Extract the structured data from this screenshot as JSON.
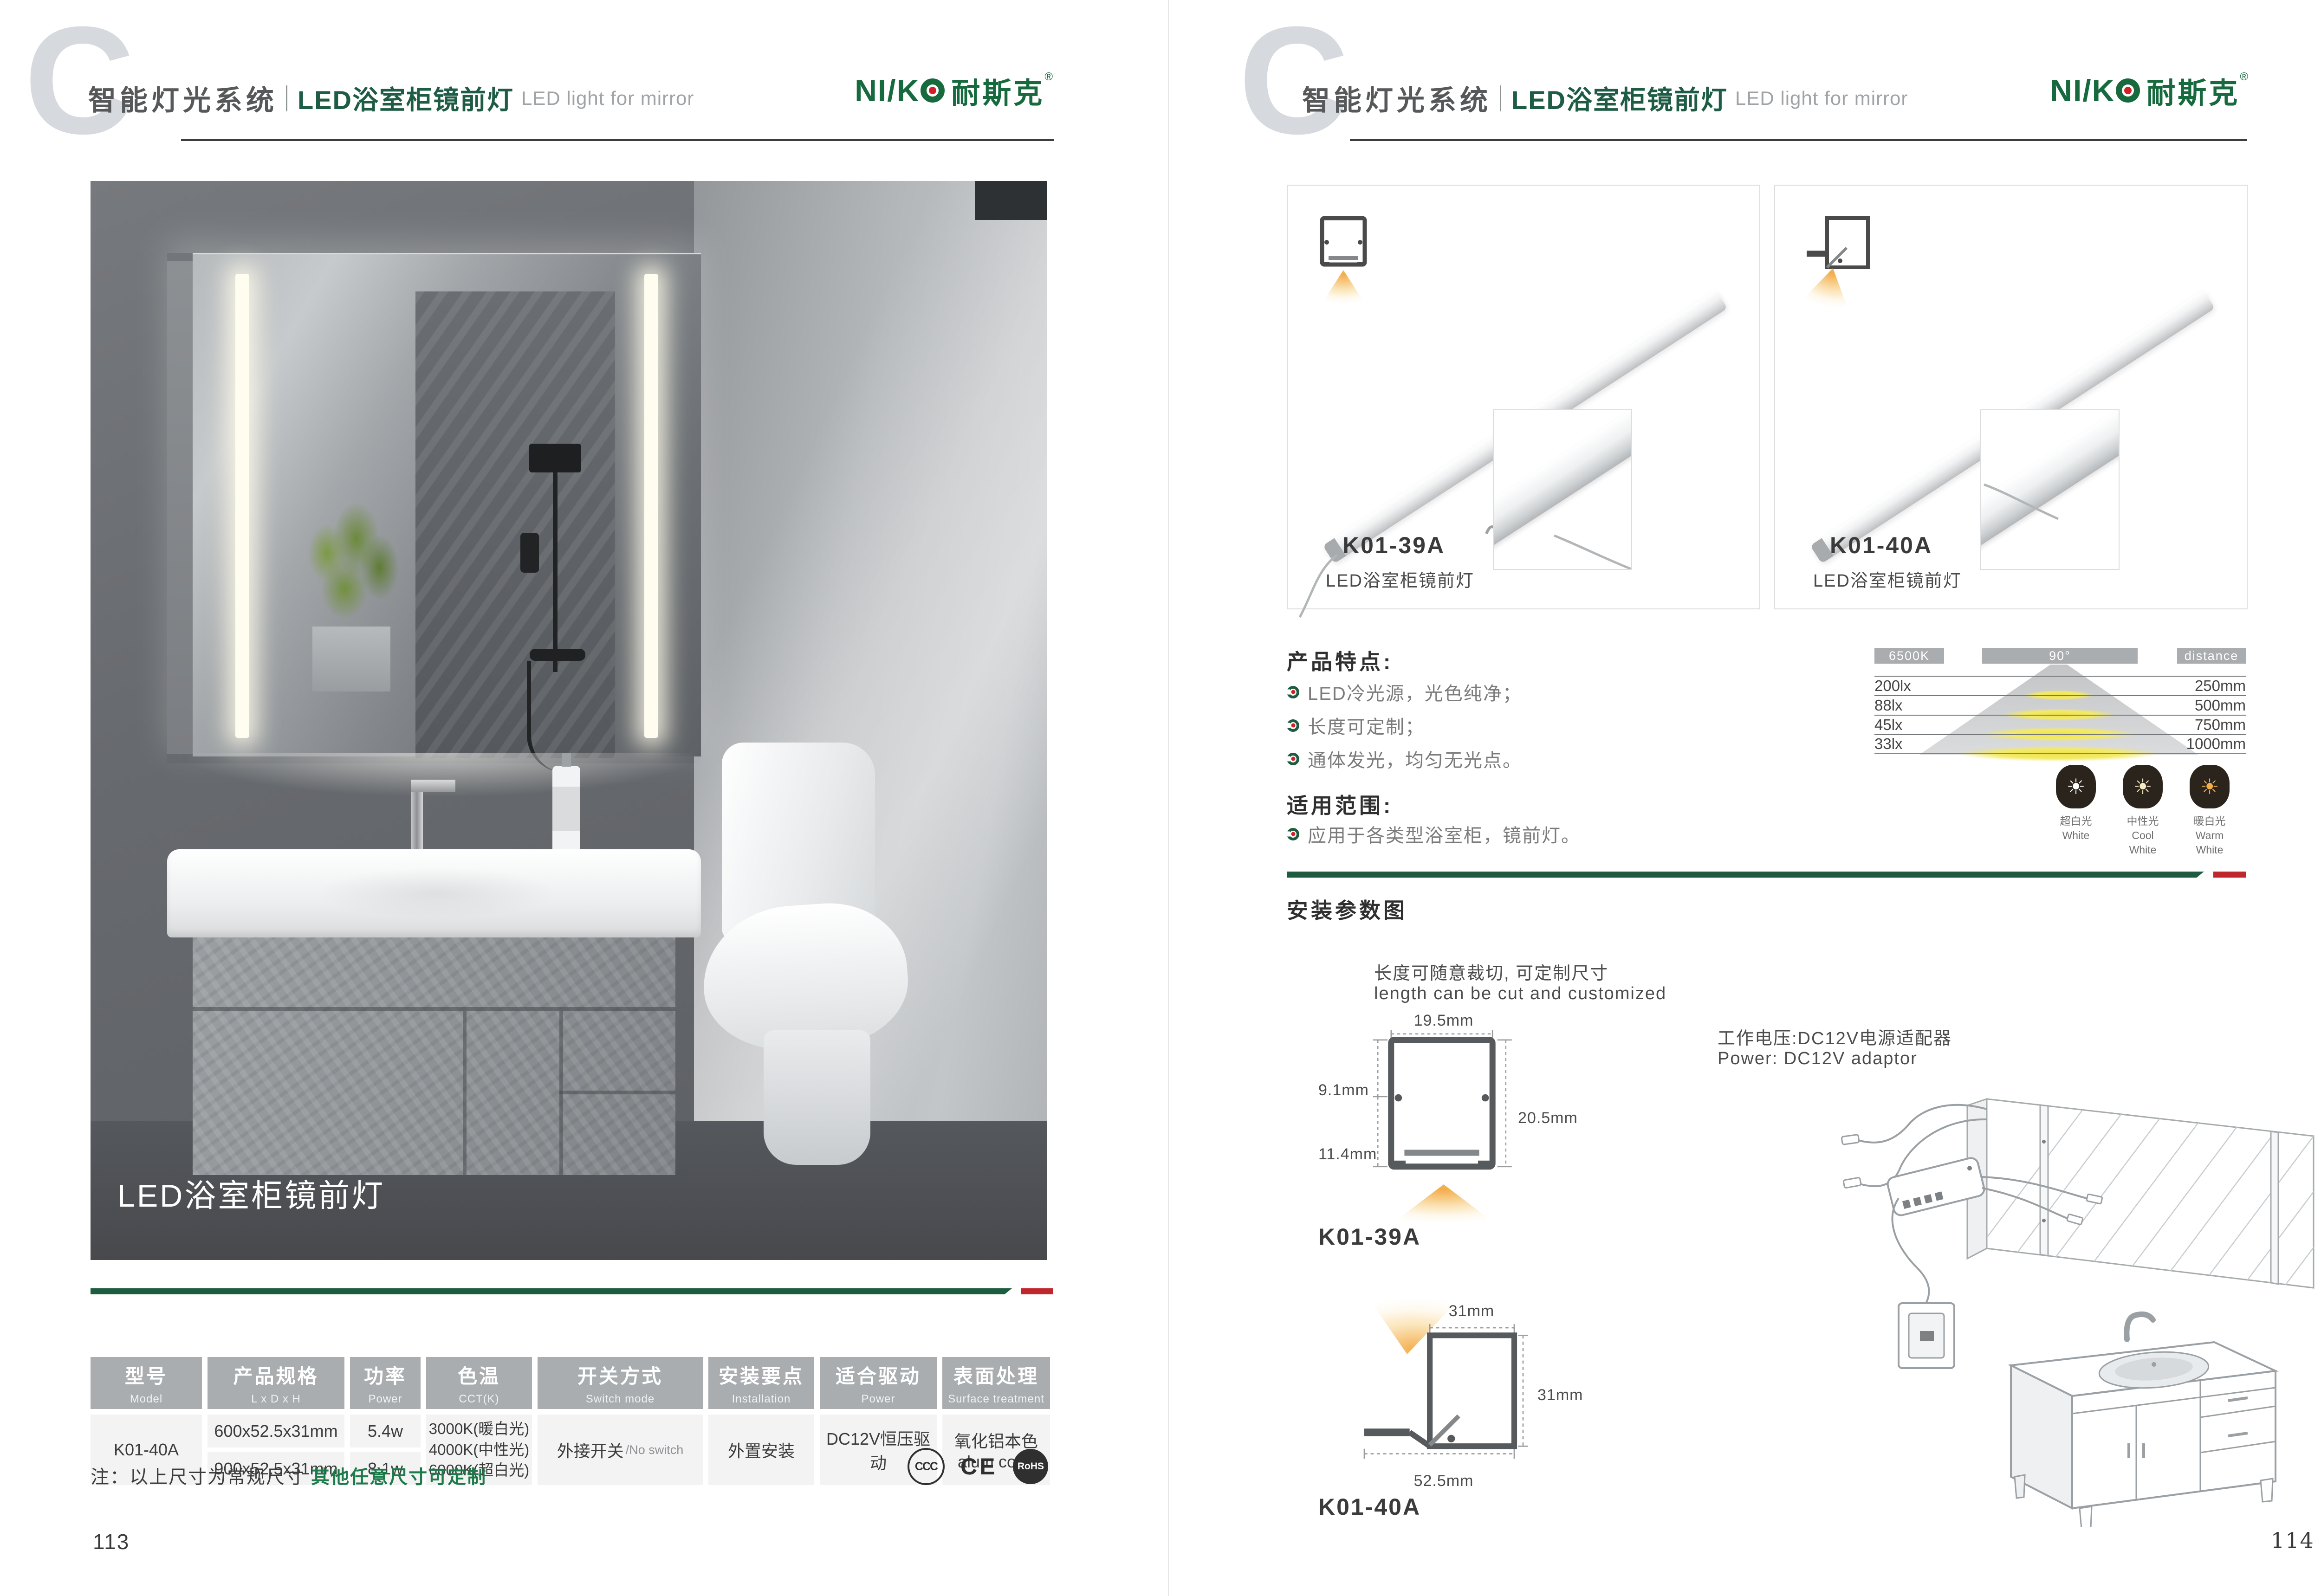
{
  "colors": {
    "brand_green": "#166a3d",
    "divider_green": "#1d5c40",
    "accent_red": "#c0272d",
    "table_header_gray": "#a9adb0"
  },
  "brand": {
    "latin": "NI/K",
    "cn": "耐斯克",
    "reg": "®"
  },
  "header": {
    "watermark": "C",
    "category": "智能灯光系统",
    "product_cn": "LED浴室柜镜前灯",
    "product_en": "LED light for mirror"
  },
  "left": {
    "photo_caption": "LED浴室柜镜前灯",
    "table_headers": [
      {
        "cn": "型号",
        "en": "Model"
      },
      {
        "cn": "产品规格",
        "en": "L x D x H"
      },
      {
        "cn": "功率",
        "en": "Power"
      },
      {
        "cn": "色温",
        "en": "CCT(K)"
      },
      {
        "cn": "开关方式",
        "en": "Switch mode"
      },
      {
        "cn": "安装要点",
        "en": "Installation"
      },
      {
        "cn": "适合驱动",
        "en": "Power"
      },
      {
        "cn": "表面处理",
        "en": "Surface treatment"
      }
    ],
    "row": {
      "model": "K01-40A",
      "spec1": "600x52.5x31mm",
      "spec2": "900x52.5x31mm",
      "power1": "5.4w",
      "power2": "8.1w",
      "cct1": "3000K(暖白光)",
      "cct2": "4000K(中性光)",
      "cct3": "6000K(超白光)",
      "switch_cn": "外接开关",
      "switch_en": "/No switch",
      "install": "外置安装",
      "driver": "DC12V恒压驱动",
      "surface_cn": "氧化铝本色",
      "surface_en": "alum color"
    },
    "note_prefix": "注：以上尺寸为常规尺寸 ",
    "note_highlight": "其他任意尺寸可定制",
    "certs": {
      "ccc": "CCC",
      "ce": "CE",
      "rohs": "RoHS"
    },
    "page_number": "113"
  },
  "right": {
    "products": [
      {
        "model": "K01-39A",
        "name": "LED浴室柜镜前灯"
      },
      {
        "model": "K01-40A",
        "name": "LED浴室柜镜前灯"
      }
    ],
    "features": {
      "title": "产品特点:",
      "items": [
        "LED冷光源，光色纯净；",
        "长度可定制；",
        "通体发光，均匀无光点。"
      ]
    },
    "application": {
      "title": "适用范围:",
      "item": "应用于各类型浴室柜，镜前灯。"
    },
    "photometry": {
      "col_cct": "6500K",
      "col_angle": "90°",
      "col_dist": "distance",
      "rows": [
        {
          "lux": "200lx",
          "dist": "250mm"
        },
        {
          "lux": "88lx",
          "dist": "500mm"
        },
        {
          "lux": "45lx",
          "dist": "750mm"
        },
        {
          "lux": "33lx",
          "dist": "1000mm"
        }
      ]
    },
    "cct_icons": [
      {
        "cn": "超白光",
        "en": "White",
        "color": "#ffffff"
      },
      {
        "cn": "中性光",
        "en": "Cool White",
        "color": "#f6ecc4"
      },
      {
        "cn": "暖白光",
        "en": "Warm White",
        "color": "#f2ae49"
      }
    ],
    "install": {
      "title": "安装参数图",
      "cut_cn": "长度可随意裁切, 可定制尺寸",
      "cut_en": "length can be cut and customized",
      "power_cn": "工作电压:DC12V电源适配器",
      "power_en": "Power: DC12V adaptor",
      "p1": {
        "model": "K01-39A",
        "top": "19.5mm",
        "left_top": "9.1mm",
        "left_bottom": "11.4mm",
        "right": "20.5mm"
      },
      "p2": {
        "model": "K01-40A",
        "top": "31mm",
        "right": "31mm",
        "bottom": "52.5mm"
      }
    },
    "page_number": "114"
  }
}
